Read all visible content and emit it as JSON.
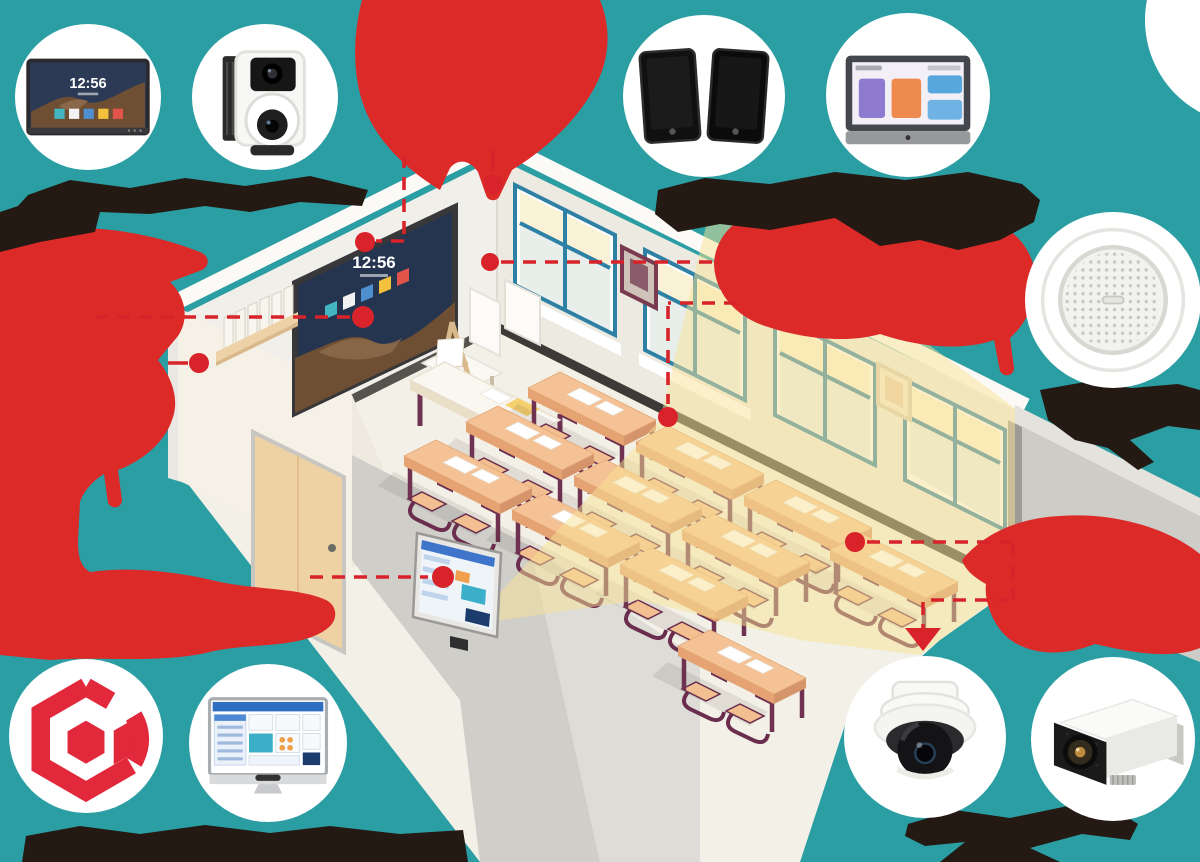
{
  "scene": {
    "colors": {
      "teal": "#2B9EA4",
      "red": "#DC2A28",
      "line_red": "#D8232B",
      "ink": "#241913",
      "floor": "#F3F0E7",
      "wall": "#F1EFE9",
      "highlight": "#F7E296",
      "window_blue": "#2E80A4",
      "desk_tan": "#F5C295",
      "chair_maroon": "#6B2D4E"
    },
    "caption_style": "illegible-ink-blob"
  },
  "room": {
    "display": {
      "clock": "12:56"
    }
  },
  "badges": {
    "flat_panel": {
      "name": "interactive-flat-panel-display",
      "clock": "12:56"
    },
    "ptz_camera": {
      "name": "ptz-video-camera"
    },
    "speakers": {
      "name": "cabinet-speaker-pair"
    },
    "control_panel": {
      "name": "smart-control-panel"
    },
    "ceiling_speaker": {
      "name": "ceiling-speaker"
    },
    "logo": {
      "name": "brand-logo"
    },
    "class_card": {
      "name": "class-info-display"
    },
    "dome_camera": {
      "name": "dome-camera"
    },
    "box_camera": {
      "name": "box-camera"
    }
  }
}
